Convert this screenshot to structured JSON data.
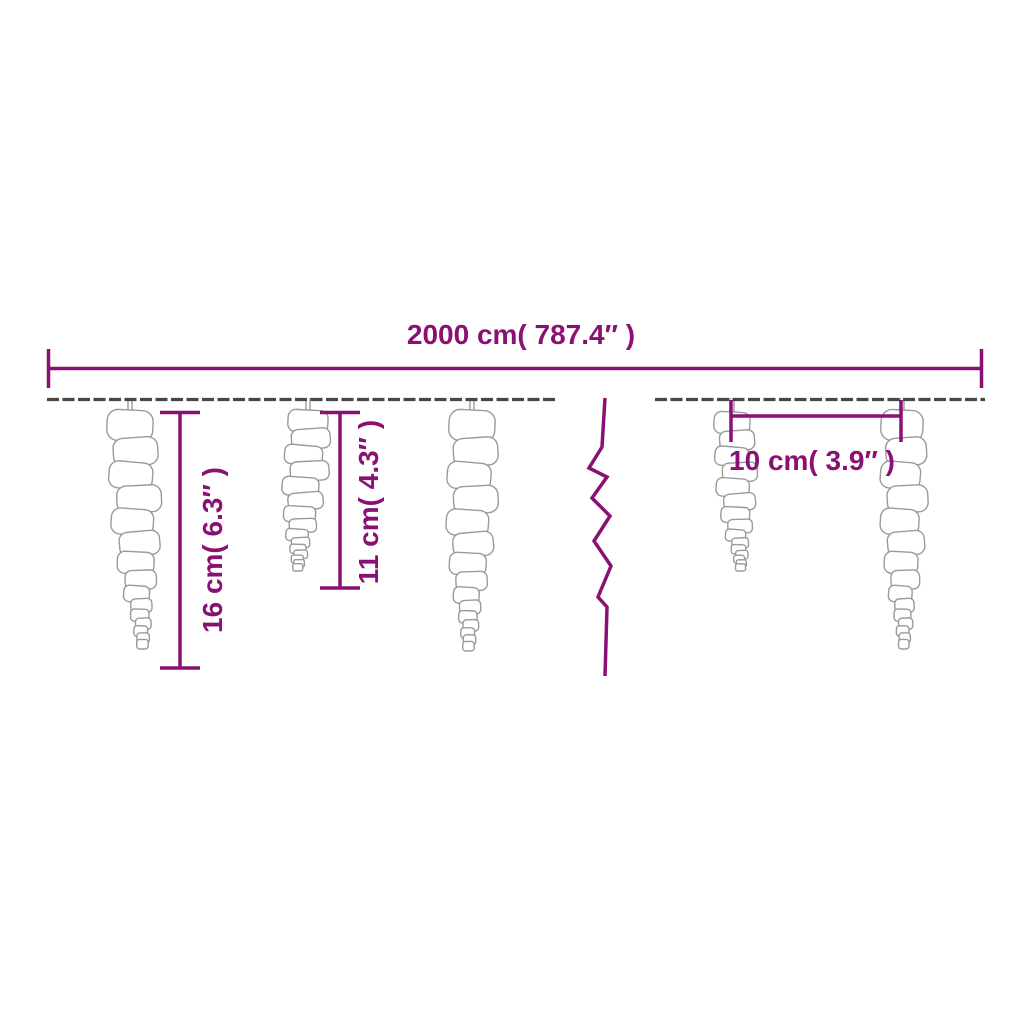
{
  "page": {
    "background": "#ffffff",
    "description": "Dimension diagram of icicle string lights"
  },
  "colors": {
    "accent": "#8A1173",
    "wire": "#474747",
    "icicle_outline": "#9a9a9a",
    "icicle_fill": "#ffffff"
  },
  "dimensions": {
    "total_length": {
      "label": "2000 cm( 787.4″ )"
    },
    "long_icicle_height": {
      "label": "16 cm( 6.3″ )"
    },
    "medium_icicle_height": {
      "label": "11 cm( 4.3″ )"
    },
    "icicle_spacing": {
      "label": "10 cm( 3.9″ )"
    }
  },
  "icicles": [
    {
      "cx": 130,
      "top": 410,
      "length": 258,
      "top_width": 46,
      "lean": 14
    },
    {
      "cx": 308,
      "top": 410,
      "length": 180,
      "top_width": 40,
      "lean": -12
    },
    {
      "cx": 472,
      "top": 410,
      "length": 260,
      "top_width": 46,
      "lean": -4
    },
    {
      "cx": 732,
      "top": 412,
      "length": 178,
      "top_width": 36,
      "lean": 10
    },
    {
      "cx": 902,
      "top": 410,
      "length": 258,
      "top_width": 42,
      "lean": 2
    }
  ]
}
